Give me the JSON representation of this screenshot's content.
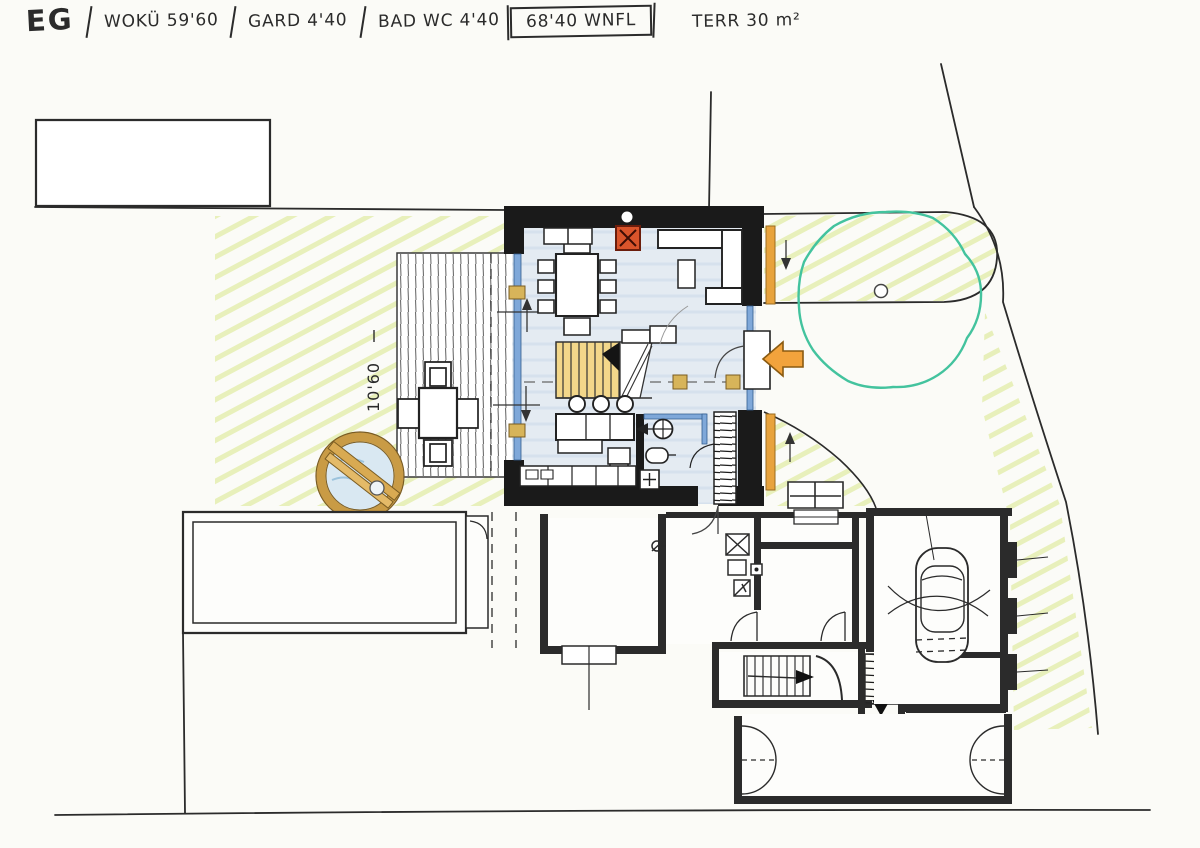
{
  "title_bar": {
    "floor_label": "EG",
    "segments": [
      {
        "label": "WOKÜ 59'60"
      },
      {
        "label": "GARD 4'40"
      },
      {
        "label": "BAD WC 4'40"
      },
      {
        "label": "68'40 WNFL",
        "boxed": true
      },
      {
        "label": "TERR 30 m²"
      }
    ]
  },
  "plan": {
    "annotations": {
      "terrace_width": "10'60"
    },
    "marks": {
      "shaft_mark": "ØX"
    },
    "colors": {
      "wall": "#1a1a1a",
      "line": "#2b2b2b",
      "glazing": "#7fa8d9",
      "floor_wash": "#e4ebf2",
      "wood": "#d7b45a",
      "stair_wood": "#f3d78a",
      "shutter": "#e8a33d",
      "accent_arrow": "#f2a33c",
      "stove": "#d9542b",
      "lawn": "#d8e78a",
      "tree": "#43c39e",
      "water": "#d9e8f2",
      "tub_rim": "#c99b45"
    }
  }
}
